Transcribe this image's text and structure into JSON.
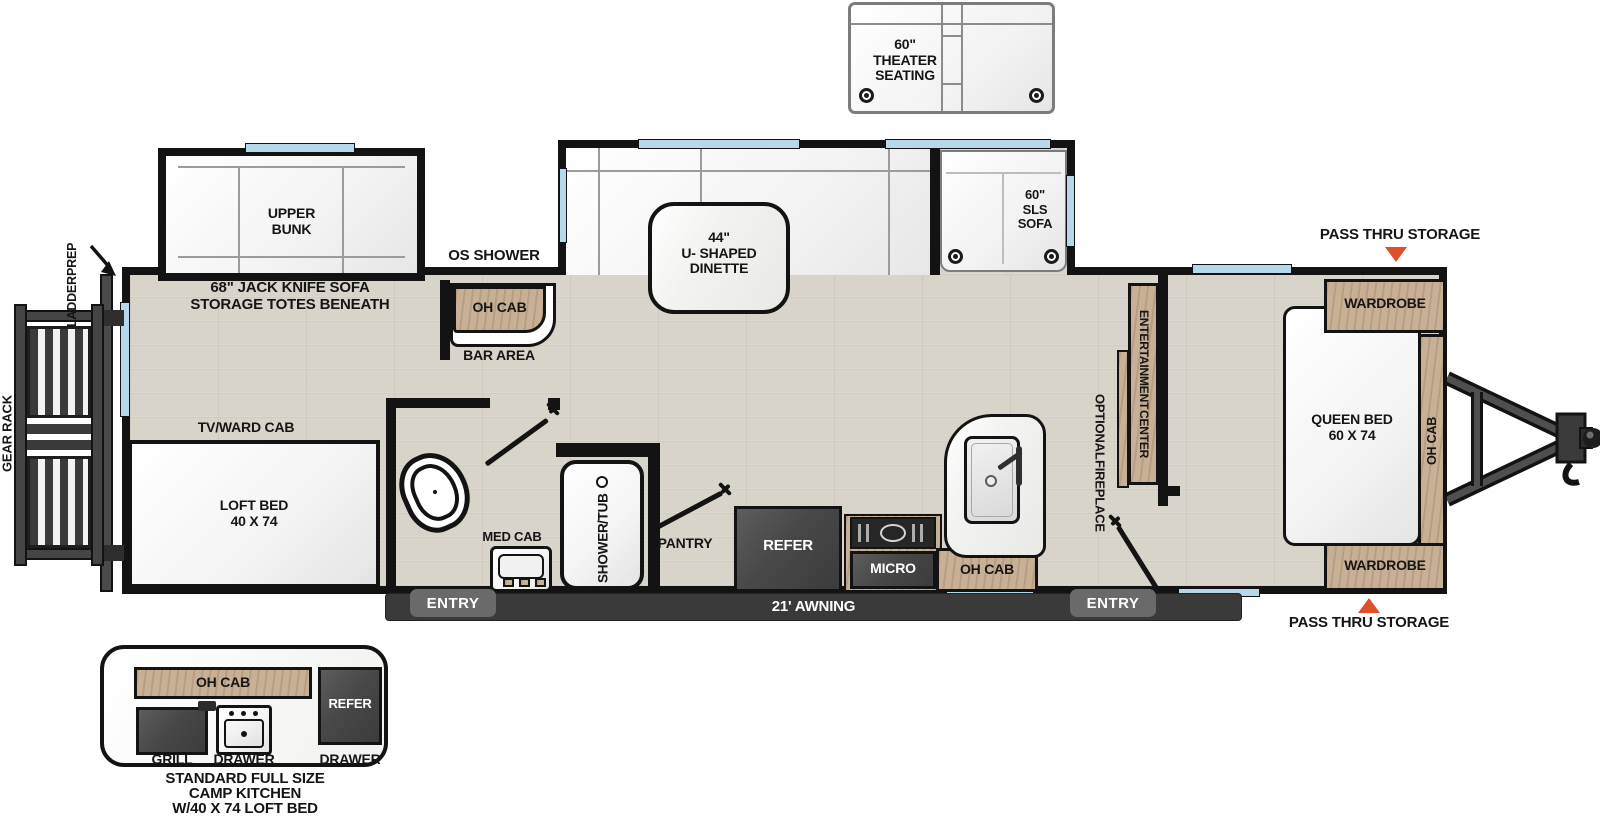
{
  "colors": {
    "wall": "#131313",
    "floor": "#D9D4CA",
    "wood": "#C8B096",
    "appliance_dark": "#474747",
    "window_glass": "#B5D8EA",
    "accent_triangle": "#DF4F28"
  },
  "exterior": {
    "theater_seating": {
      "line1": "60\"",
      "line2": "THEATER",
      "line3": "SEATING"
    },
    "pass_thru_storage_top": "PASS THRU STORAGE",
    "pass_thru_storage_bottom": "PASS THRU STORAGE",
    "ladder_prep": {
      "line1": "LADDER",
      "line2": "PREP"
    },
    "gear_rack": "GEAR RACK",
    "os_shower": "OS SHOWER",
    "awning": "21' AWNING",
    "entry_left": "ENTRY",
    "entry_right": "ENTRY"
  },
  "interior": {
    "upper_bunk": {
      "line1": "UPPER",
      "line2": "BUNK"
    },
    "jack_knife_sofa": {
      "line1": "68\" JACK KNIFE SOFA",
      "line2": "STORAGE TOTES BENEATH"
    },
    "bar_oh_cab": "OH CAB",
    "bar_area": "BAR AREA",
    "dinette": {
      "line1": "44\"",
      "line2": "U- SHAPED",
      "line3": "DINETTE"
    },
    "sls_sofa": {
      "line1": "60\"",
      "line2": "SLS",
      "line3": "SOFA"
    },
    "tv_ward_cab": "TV/WARD CAB",
    "loft_bed": {
      "line1": "LOFT BED",
      "line2": "40 X 74"
    },
    "med_cab": "MED CAB",
    "shower_tub": {
      "line1": "SHOWER",
      "line2": "/TUB"
    },
    "pantry": "PANTRY",
    "refer": "REFER",
    "micro": "MICRO",
    "oh_cab_kitchen": "OH CAB",
    "entertainment_center": {
      "line1": "ENTERTAINMENT",
      "line2": "CENTER"
    },
    "optional_fireplace": {
      "line1": "OPTIONAL",
      "line2": "FIREPLACE"
    },
    "queen_bed": {
      "line1": "QUEEN BED",
      "line2": "60 X 74"
    },
    "wardrobe_rear": "WARDROBE",
    "wardrobe_front": "WARDROBE",
    "oh_cab_bedroom": "OH CAB"
  },
  "camp_kitchen": {
    "oh_cab": "OH CAB",
    "refer": "REFER",
    "grill": "GRILL",
    "drawer_center": "DRAWER",
    "drawer_right": "DRAWER",
    "caption": {
      "line1": "STANDARD FULL SIZE",
      "line2": "CAMP KITCHEN",
      "line3": "W/40 X 74 LOFT BED"
    }
  }
}
